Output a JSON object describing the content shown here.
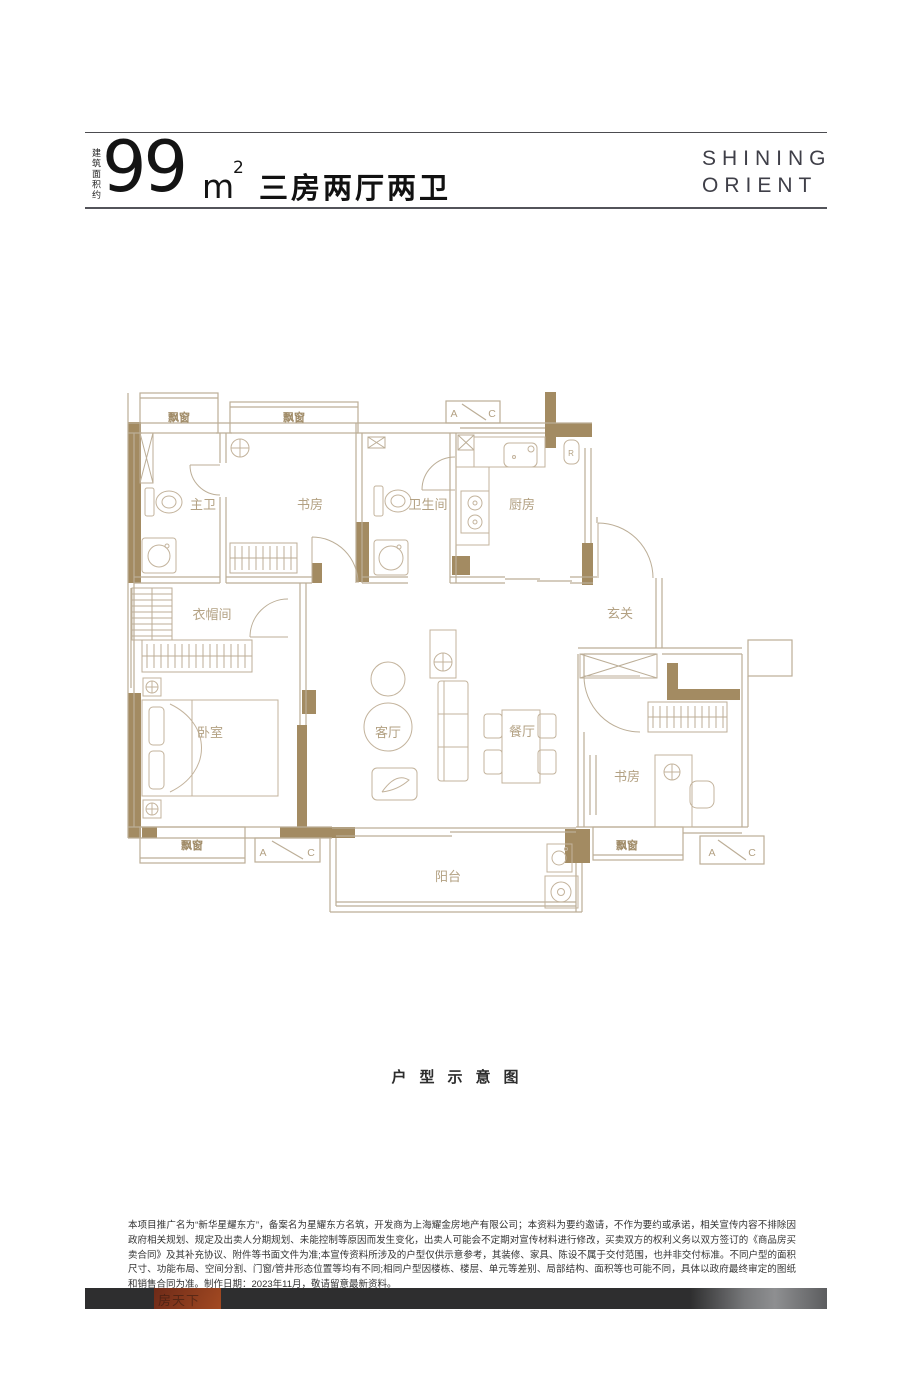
{
  "header": {
    "area_prefix": "建筑面积约",
    "area_value": "99",
    "area_unit": "m",
    "area_exp": "2",
    "layout_title": "三房两厅两卫",
    "brand": {
      "line1": "SHINING",
      "line2": "ORIENT"
    }
  },
  "floorplan": {
    "rooms": [
      {
        "key": "master-bath",
        "label": "主卫"
      },
      {
        "key": "study-north",
        "label": "书房"
      },
      {
        "key": "bathroom",
        "label": "卫生间"
      },
      {
        "key": "kitchen",
        "label": "厨房"
      },
      {
        "key": "cloakroom",
        "label": "衣帽间"
      },
      {
        "key": "foyer",
        "label": "玄关"
      },
      {
        "key": "bedroom",
        "label": "卧室"
      },
      {
        "key": "living-room",
        "label": "客厅"
      },
      {
        "key": "dining-room",
        "label": "餐厅"
      },
      {
        "key": "study-south",
        "label": "书房"
      },
      {
        "key": "balcony",
        "label": "阳台"
      }
    ],
    "bay_window_label": "飘窗",
    "ac_left": "A",
    "ac_right": "C",
    "fridge_label": "R"
  },
  "caption": "户型示意图",
  "disclaimer": "本项目推广名为“新华星耀东方”，备案名为星耀东方名筑，开发商为上海耀金房地产有限公司；本资料为要约邀请，不作为要约或承诺，相关宣传内容不排除因政府相关规划、规定及出卖人分期规划、未能控制等原因而发生变化，出卖人可能会不定期对宣传材料进行修改，买卖双方的权利义务以双方签订的《商品房买卖合同》及其补充协议、附件等书面文件为准;本宣传资料所涉及的户型仅供示意参考，其装修、家具、陈设不属于交付范围，也并非交付标准。不同户型的面积尺寸、功能布局、空间分割、门窗/管井形态位置等均有不同;相同户型因楼栋、楼层、单元等差别、局部结构、面积等也可能不同，具体以政府最终审定的图纸和销售合同为准。制作日期：2023年11月，敬请留意最新资料。",
  "footer": {
    "watermark_text": "房天下"
  },
  "colors": {
    "wall_fill": "#a38b62",
    "line": "#bcae97",
    "label": "#b3a183",
    "bay_label": "#a08b67",
    "accent_red": "#9c4424",
    "bar_bg": "#2e2e2f"
  }
}
